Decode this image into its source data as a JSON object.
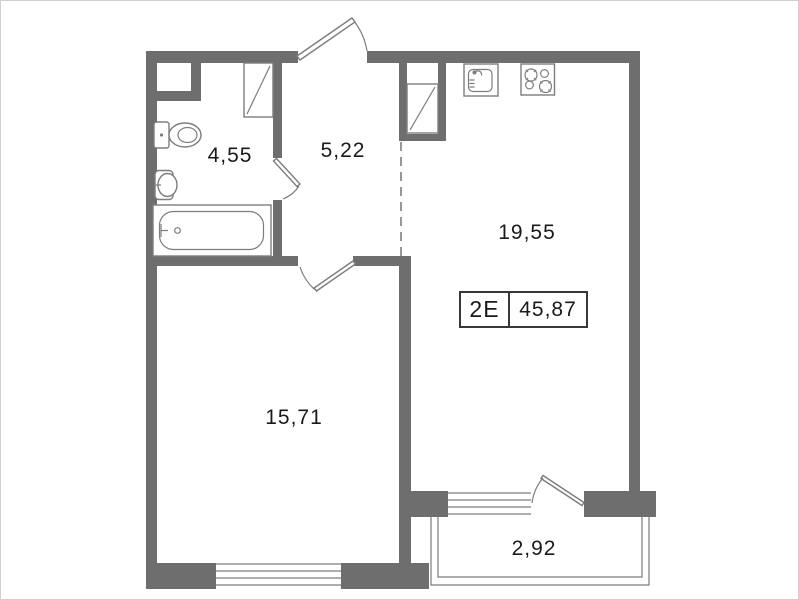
{
  "plan": {
    "rooms": [
      {
        "name": "bathroom",
        "area": "4,55"
      },
      {
        "name": "hallway",
        "area": "5,22"
      },
      {
        "name": "kitchen-living-room",
        "area": "19,55"
      },
      {
        "name": "bedroom",
        "area": "15,71"
      },
      {
        "name": "balcony",
        "area": "2,92"
      }
    ],
    "apartment_label": {
      "type": "2Е",
      "total_area": "45,87"
    }
  },
  "icons": {
    "bathroom": [
      "toilet-icon",
      "washbasin-icon",
      "bathtub-icon"
    ],
    "kitchen": [
      "kitchen-sink-icon",
      "stove-icon"
    ],
    "openings": [
      "entrance-door-icon",
      "bathroom-door-icon",
      "bedroom-door-icon",
      "balcony-door-icon",
      "window-icon",
      "ventilation-shaft-icon",
      "balcony-railing-icon"
    ]
  },
  "colors": {
    "wall": "#6e6e6e",
    "thin_line": "#7d7d7d",
    "text": "#1a1a1a",
    "background": "#ffffff"
  }
}
